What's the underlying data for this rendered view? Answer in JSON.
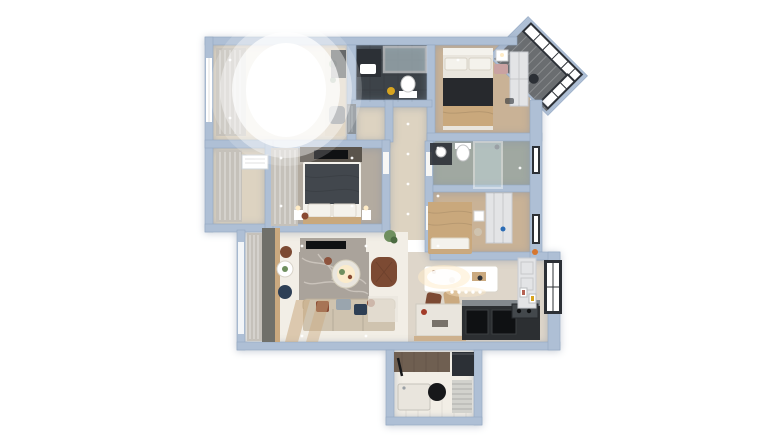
{
  "scene": {
    "description": "3D rendered top-down floor plan of an apartment on a white background",
    "background": "#ffffff"
  },
  "palette": {
    "bg": "#ffffff",
    "wall": "#aebfd5",
    "wall-edge": "#92a7c2",
    "floor-wood": "#e0d5c2",
    "floor-beige": "#ddd3c1",
    "floor-taupe": "#b3aba0",
    "floor-white": "#f2eee6",
    "floor-tan": "#c9b296",
    "floor-gray": "#ded6ca",
    "bath-dark": "#3d4349",
    "tile-gray": "#a0a8a1",
    "balcony-slat": "#6a6d70",
    "curtain": "#c5c1ba",
    "glass": "#c9dde3",
    "frame-dark": "#2c3036",
    "white": "#ffffff",
    "warm-light": "#ffecc7",
    "sofa": "#cfc3af",
    "bed-dark": "#42474d",
    "duvet-black": "#27292d",
    "throw-tan": "#c9a87c",
    "pillow-white": "#f4f2ec",
    "rug-marble": "#aaa39b",
    "rug-vein": "#cdc7bf",
    "armchair-brown": "#7c4a33",
    "pillow-rust": "#8a4a33",
    "pillow-gray": "#9aa5ae",
    "pillow-navy": "#2e3f55",
    "kitchen-dark": "#2c2f32",
    "counter-steel": "#9aa0a5",
    "cabinet-wood": "#5a544c",
    "wood-light": "#caa97f",
    "plant-green": "#6f8f5f",
    "plant-dark": "#4c6b42",
    "entry-brown": "#6f5f51",
    "mat": "#d2d2cd",
    "black": "#17181a",
    "appliance": "#0f1113",
    "island": "#e9e5dd",
    "door-white": "#f7f7f5",
    "yellow": "#d8a520",
    "red": "#a33b28",
    "blue": "#2b6cb5",
    "pink": "#c9a2a2",
    "wardrobe": "#e3e4e6",
    "steel": "#8b9298",
    "shelf": "#d9cdb9",
    "gray-chair": "#7d8287",
    "divider": "#70706a",
    "orange": "#d7772f",
    "cooktop": "#43484c"
  },
  "rooms": [
    {
      "name": "bright-room-top-left",
      "furniture": [
        "window",
        "curtains",
        "overexposed-daylight",
        "shelf-with-plants",
        "desk",
        "chair"
      ]
    },
    {
      "name": "dark-bathroom",
      "furniture": [
        "vanity-sink",
        "glass-shower",
        "toilet",
        "bucket"
      ]
    },
    {
      "name": "bedroom-top-right",
      "furniture": [
        "double-bed",
        "pillows",
        "dark-duvet",
        "tan-throw",
        "bedside-table",
        "bench",
        "wardrobe"
      ]
    },
    {
      "name": "corner-balcony",
      "furniture": [
        "mullioned-windows",
        "wood-slat-floor",
        "chair"
      ]
    },
    {
      "name": "utility-room",
      "furniture": [
        "curtains",
        "ac-unit"
      ]
    },
    {
      "name": "master-bedroom",
      "furniture": [
        "curtains",
        "tv-cabinet",
        "double-bed",
        "pillows",
        "bedside-tables",
        "lamps"
      ]
    },
    {
      "name": "hallway",
      "furniture": [
        "downlights",
        "plant",
        "vent-grille",
        "doors"
      ]
    },
    {
      "name": "bathroom-2",
      "furniture": [
        "vanity-sink",
        "toilet",
        "glass-shower",
        "window"
      ]
    },
    {
      "name": "bedroom-tan",
      "furniture": [
        "bed",
        "pillows",
        "bedside-table",
        "wardrobe",
        "window",
        "stool"
      ]
    },
    {
      "name": "living-room",
      "furniture": [
        "balcony-curtains",
        "wood-divider",
        "side-tables",
        "stools",
        "tv-console",
        "marble-rug",
        "coffee-table",
        "brown-armchair",
        "sofa",
        "throw-pillows",
        "floor-runner"
      ]
    },
    {
      "name": "dining-kitchen",
      "furniture": [
        "dining-table",
        "chairs",
        "pendant-lights",
        "island",
        "dark-counter",
        "ovens",
        "cooktop",
        "cabinets",
        "art-frames",
        "window",
        "flowers"
      ]
    },
    {
      "name": "entry-room",
      "furniture": [
        "accent-wall",
        "shoe-cabinet",
        "shower-tray",
        "round-rug",
        "striped-mat",
        "umbrella"
      ]
    }
  ]
}
